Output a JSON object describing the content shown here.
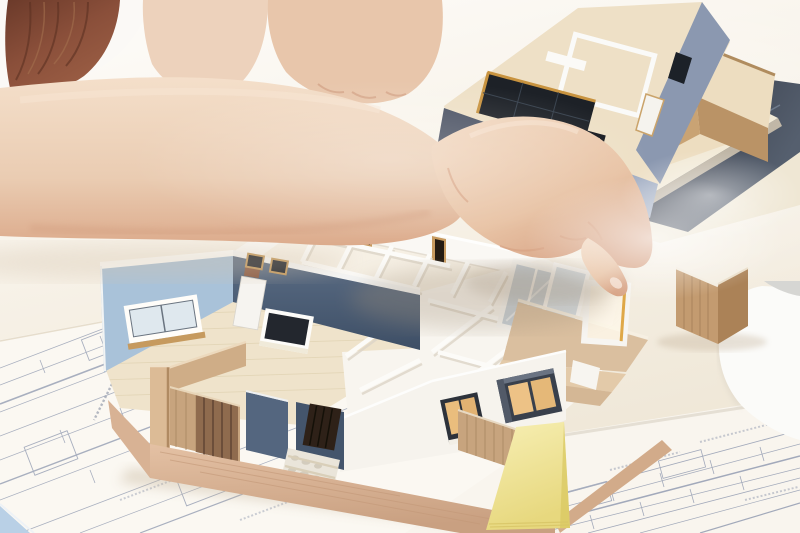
{
  "scene": {
    "description": "Photograph: a hand points with index finger at a white architectural scale model of a single-story house floor plan sitting on blueprints; a flat-roof upper-story model rests on stacked presentation boards at top right; yellow sticky-note pad, technical drawings and a white laptop corner on a bright table; person with auburn hair and white shirt at top left.",
    "objects": [
      "pointing-hand",
      "floor-plan-model",
      "roof-model",
      "blueprints",
      "sticky-note-pad",
      "laptop",
      "wooden-fence-piece"
    ]
  },
  "palette": {
    "table_warm": "#f6f0e5",
    "paper_white": "#fbf8f2",
    "paper_white2": "#f9f5ee",
    "blueprint_line": "#8d97ae",
    "skin": "#edd2bc",
    "skin_shadow": "#d9a88a",
    "hair": "#7c4635",
    "shirt": "#fbf9f6",
    "wall_white": "#faf8f4",
    "wall_light_blue": "#a9c2d9",
    "wall_navy": "#44556c",
    "wall_slate_light": "#a0acc2",
    "wall_slate_dark": "#4c5364",
    "roof_cream": "#eee0c6",
    "floor_tan": "#efe3cb",
    "wood_base": "#dcb696",
    "wood_fence": "#c7a47e",
    "plywood": "#c9a374",
    "frame_charcoal": "#2c313a",
    "glass_warm": "#eabd7d",
    "glass_cool": "#c5cfd8",
    "glass_dark": "#1d2127",
    "board_dark": "#2c2d34",
    "sticky_yellow": "#f2e69c",
    "laptop_white": "#fbfbf9",
    "accent_gold": "#d89c3a",
    "stone_path": "#eae5da"
  }
}
